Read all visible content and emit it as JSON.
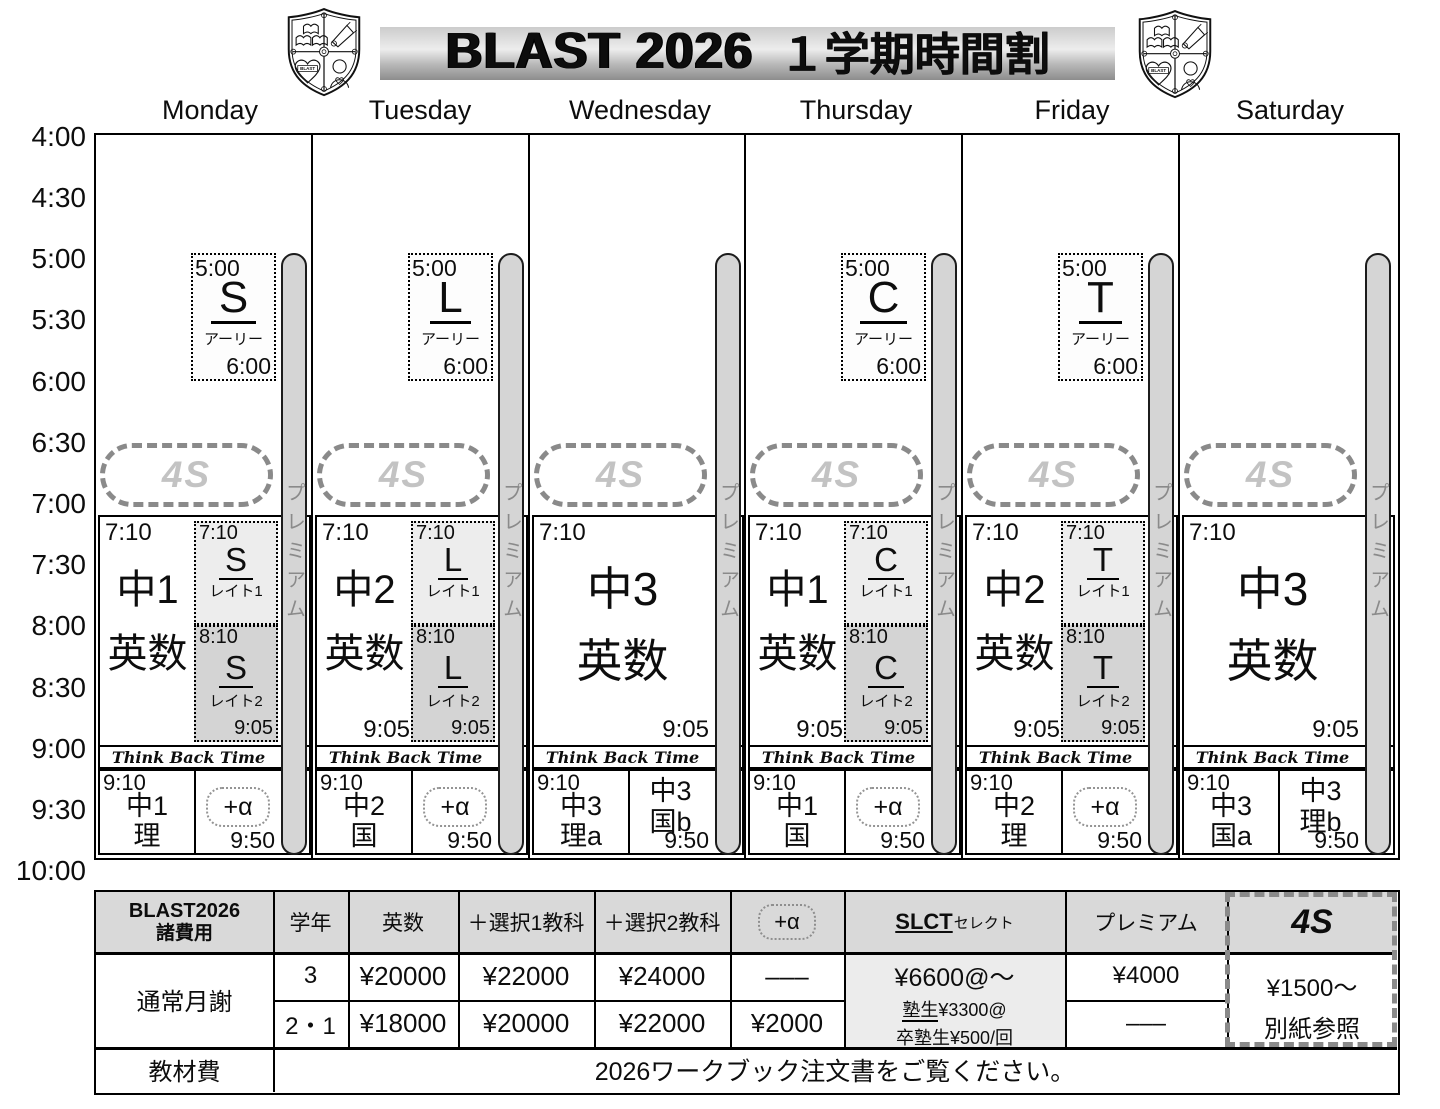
{
  "header": {
    "title_en": "BLAST 2026",
    "title_ja": "１学期時間割",
    "crest_text": "BLAST"
  },
  "day_names": [
    "Monday",
    "Tuesday",
    "Wednesday",
    "Thursday",
    "Friday",
    "Saturday"
  ],
  "time_axis": [
    "4:00",
    "4:30",
    "5:00",
    "5:30",
    "6:00",
    "6:30",
    "7:00",
    "7:30",
    "8:00",
    "8:30",
    "9:00",
    "9:30",
    "10:00"
  ],
  "labels": {
    "premium": "プレミアム",
    "four_s": "4S",
    "think_back_time": "Think Back Time",
    "plus_alpha": "+α"
  },
  "days": [
    {
      "name": "Monday",
      "early": {
        "start": "5:00",
        "course": "S",
        "type": "アーリー",
        "end": "6:00"
      },
      "main": {
        "start": "7:10",
        "grade": "中1",
        "subject": "英数"
      },
      "late1": {
        "start": "7:10",
        "course": "S",
        "type": "レイト1"
      },
      "late2": {
        "start": "8:10",
        "course": "S",
        "type": "レイト2",
        "end": "9:05"
      },
      "evening": {
        "start": "9:10",
        "grade": "中1",
        "subject": "理",
        "end": "9:50"
      }
    },
    {
      "name": "Tuesday",
      "early": {
        "start": "5:00",
        "course": "L",
        "type": "アーリー",
        "end": "6:00"
      },
      "main": {
        "start": "7:10",
        "grade": "中2",
        "subject": "英数",
        "end": "9:05"
      },
      "late1": {
        "start": "7:10",
        "course": "L",
        "type": "レイト1"
      },
      "late2": {
        "start": "8:10",
        "course": "L",
        "type": "レイト2",
        "end": "9:05"
      },
      "evening": {
        "start": "9:10",
        "grade": "中2",
        "subject": "国",
        "end": "9:50"
      }
    },
    {
      "name": "Wednesday",
      "main": {
        "start": "7:10",
        "grade": "中3",
        "subject": "英数",
        "end": "9:05"
      },
      "evening": {
        "start": "9:10",
        "grade": "中3",
        "subject": "理a",
        "end": "9:50"
      },
      "evening2": {
        "grade": "中3",
        "subject": "国b"
      }
    },
    {
      "name": "Thursday",
      "early": {
        "start": "5:00",
        "course": "C",
        "type": "アーリー",
        "end": "6:00"
      },
      "main": {
        "start": "7:10",
        "grade": "中1",
        "subject": "英数",
        "end": "9:05"
      },
      "late1": {
        "start": "7:10",
        "course": "C",
        "type": "レイト1"
      },
      "late2": {
        "start": "8:10",
        "course": "C",
        "type": "レイト2",
        "end": "9:05"
      },
      "evening": {
        "start": "9:10",
        "grade": "中1",
        "subject": "国",
        "end": "9:50"
      }
    },
    {
      "name": "Friday",
      "early": {
        "start": "5:00",
        "course": "T",
        "type": "アーリー",
        "end": "6:00"
      },
      "main": {
        "start": "7:10",
        "grade": "中2",
        "subject": "英数",
        "end": "9:05"
      },
      "late1": {
        "start": "7:10",
        "course": "T",
        "type": "レイト1"
      },
      "late2": {
        "start": "8:10",
        "course": "T",
        "type": "レイト2",
        "end": "9:05"
      },
      "evening": {
        "start": "9:10",
        "grade": "中2",
        "subject": "理",
        "end": "9:50"
      }
    },
    {
      "name": "Saturday",
      "main": {
        "start": "7:10",
        "grade": "中3",
        "subject": "英数",
        "end": "9:05"
      },
      "evening": {
        "start": "9:10",
        "grade": "中3",
        "subject": "国a",
        "end": "9:50"
      },
      "evening2": {
        "grade": "中3",
        "subject": "理b"
      }
    }
  ],
  "fees": {
    "corner_line1": "BLAST2026",
    "corner_line2": "諸費用",
    "col_headers": {
      "grade": "学年",
      "eisu": "英数",
      "sel1": "＋選択1教科",
      "sel2": "＋選択2教科",
      "plus_alpha": "+α",
      "slct_main": "SLCT",
      "slct_sub": "セレクト",
      "premium": "プレミアム",
      "four_s": "4S"
    },
    "monthly_label": "通常月謝",
    "rows": [
      {
        "grade": "3",
        "eisu": "¥20000",
        "sel1": "¥22000",
        "sel2": "¥24000",
        "plus_alpha": "–––",
        "premium": "¥4000"
      },
      {
        "grade": "2・1",
        "eisu": "¥18000",
        "sel1": "¥20000",
        "sel2": "¥22000",
        "plus_alpha": "¥2000",
        "premium": "–––"
      }
    ],
    "slct_cell": {
      "line1": "¥6600@〜",
      "line2_head": "塾生",
      "line2_rest": "¥3300@",
      "line3": "卒塾生¥500/回"
    },
    "four_s_cell": {
      "line1": "¥1500〜",
      "line2": "別紙参照"
    },
    "materials_label": "教材費",
    "materials_note": "2026ワークブック注文書をご覧ください。"
  },
  "colors": {
    "late1_bg": "#ededed",
    "late2_bg": "#d4d4d4",
    "premium_bar": "#d5d5d5",
    "table_header_bg": "#d9d9d9",
    "four_s_gray": "#c3c3c3"
  }
}
